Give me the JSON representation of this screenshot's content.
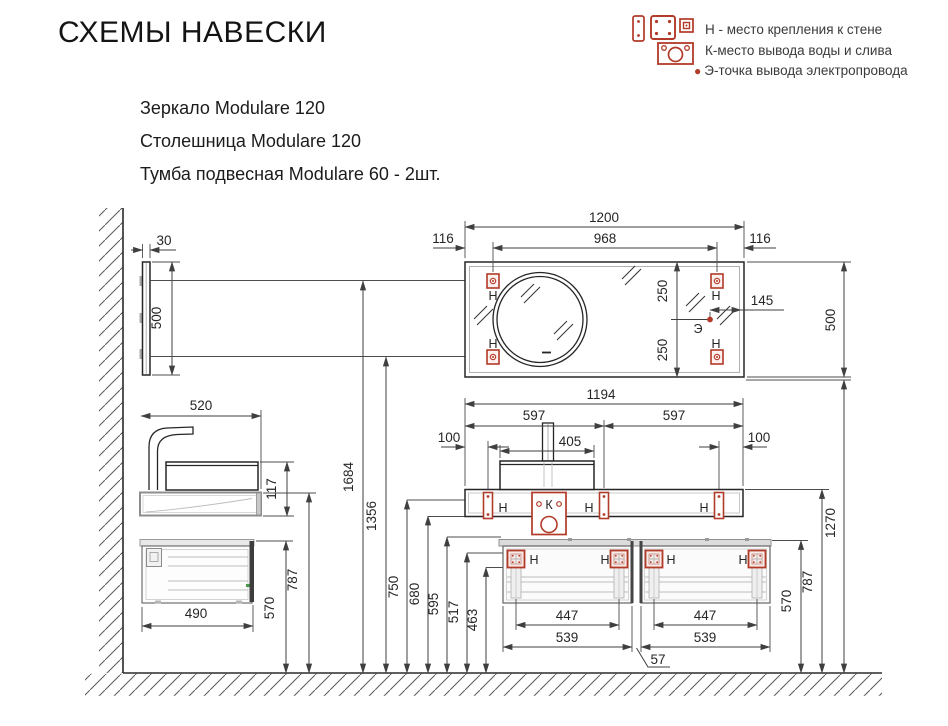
{
  "title": "СХЕМЫ НАВЕСКИ",
  "legend": {
    "items": [
      "Н - место крепления к стене",
      "К-место вывода воды и слива",
      "Э-точка вывода электропровода"
    ]
  },
  "products": {
    "mirror": "Зеркало Modulare 120",
    "worktop": "Столешница Modulare 120",
    "cabinet": "Тумба подвесная Modulare 60 - 2шт."
  },
  "markers": {
    "wall_mount": "Н",
    "water_outlet": "К",
    "electric_point": "Э"
  },
  "dims": {
    "mirror_total_width": "1200",
    "mirror_mount_span": "968",
    "mirror_mount_offset": "116",
    "mirror_height": "500",
    "mirror_mount_gap": "250",
    "electric_offset": "145",
    "mirror_depth": "30",
    "worktop_depth": "520",
    "basin_height": "117",
    "worktop_width": "1194",
    "worktop_half": "597",
    "worktop_mount_offset": "100",
    "basin_width": "405",
    "cabinet_depth": "490",
    "cabinet_width": "539",
    "cabinet_mount_span": "447",
    "cabinet_gap": "57",
    "h_mirror_top_mount": "1684",
    "h_mirror_bottom_mount": "1356",
    "h_worktop_mount": "750",
    "h_worktop_bottom": "680",
    "h_cab_mount_top": "595",
    "h_cab_mount": "517",
    "h_cab_mount_bottom": "463",
    "h_mirror_bottom": "1270",
    "h_worktop_top": "787",
    "h_cabinet_top": "570"
  },
  "colors": {
    "accent_red": "#b23a28",
    "line_dark": "#262626",
    "dim_line": "#3f3f3f"
  }
}
